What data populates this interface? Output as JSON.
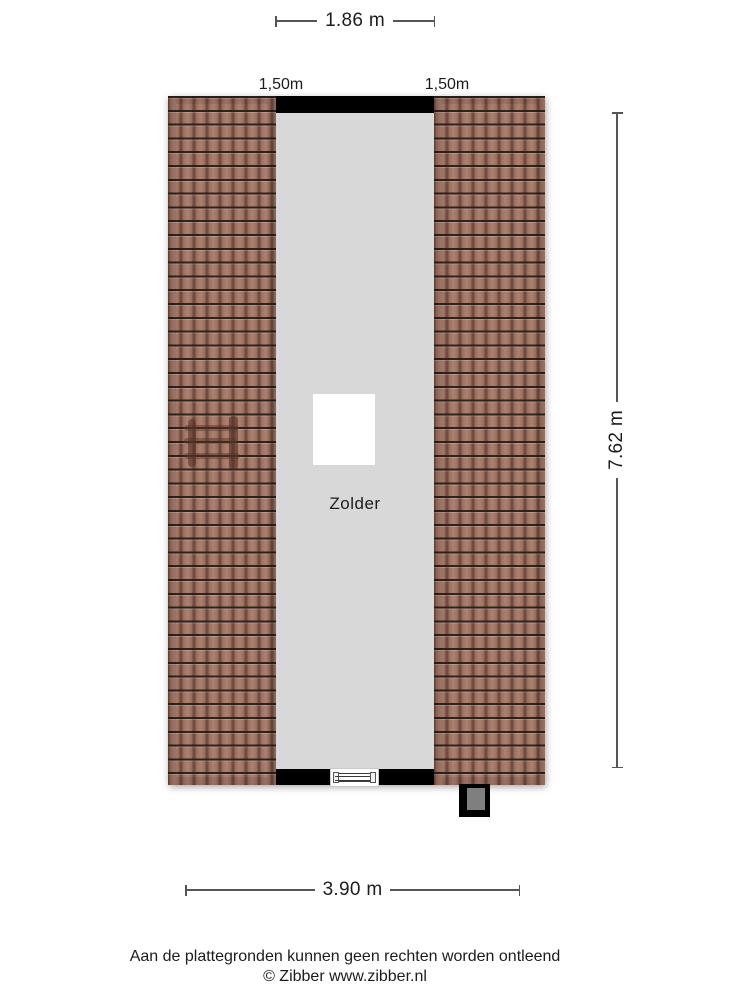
{
  "room": {
    "label": "Zolder"
  },
  "dimensions": {
    "top": "1.86 m",
    "eave_left": "1,50m",
    "eave_right": "1,50m",
    "right": "7.62 m",
    "bottom": "3.90 m"
  },
  "footer": {
    "disclaimer": "Aan de plattegronden kunnen geen rechten worden ontleend",
    "copyright": "© Zibber www.zibber.nl"
  },
  "colors": {
    "wall": "#000000",
    "interior": "#d8d8d8",
    "tile-base": "#9c7262",
    "tile-dark": "#6f4d40",
    "chimney-flue": "#7f7f7f",
    "dim-line": "#555555",
    "text": "#1c1c1c"
  }
}
